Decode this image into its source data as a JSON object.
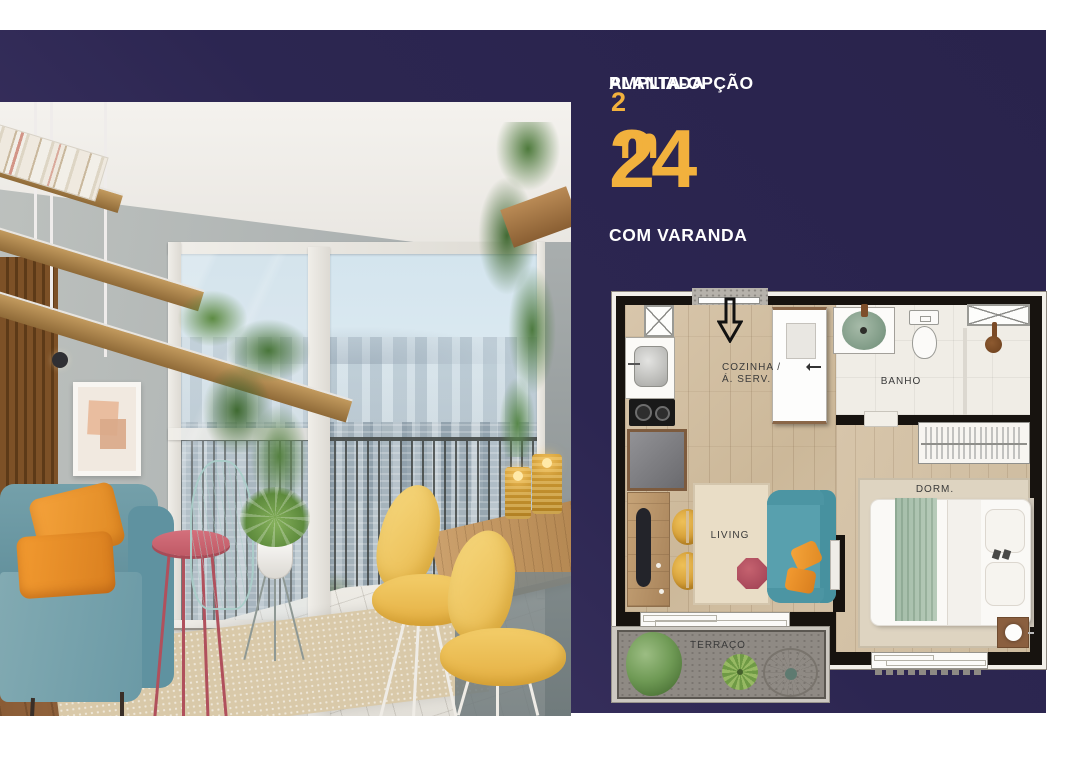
{
  "panel": {
    "title_line1": "PLANTA-OPÇÃO",
    "title_line2": "AMPLIADA",
    "area_value": "24",
    "area_unit": "m",
    "area_exponent": "2",
    "subtitle": "COM VARANDA"
  },
  "floorplan": {
    "labels": {
      "kitchen_line1": "COZINHA /",
      "kitchen_line2": "Á. SERV.",
      "bathroom": "BANHO",
      "living": "LIVING",
      "bedroom": "DORM.",
      "terrace": "TERRAÇO"
    },
    "icons": {
      "entry": "down-arrow-icon",
      "fridge": "crossed-box-icon",
      "shelf_niche": "crossed-box-icon"
    }
  },
  "colors": {
    "band_navy": "#2c2651",
    "band_gradient_light": "#4c4270",
    "accent_orange": "#f2b13d",
    "text_white": "#ffffff",
    "plan_wall": "#17130f",
    "plan_wood_floor": "#d2bfa3",
    "plan_bath_tile": "#f0ede6",
    "terrace_grey": "#8f8a84",
    "sofa_teal": "#58a0ae",
    "cushion_orange": "#f09a33",
    "table_red": "#b7525f",
    "chair_yellow": "#e4af42",
    "bed_runner_green": "#a9c1ae"
  }
}
